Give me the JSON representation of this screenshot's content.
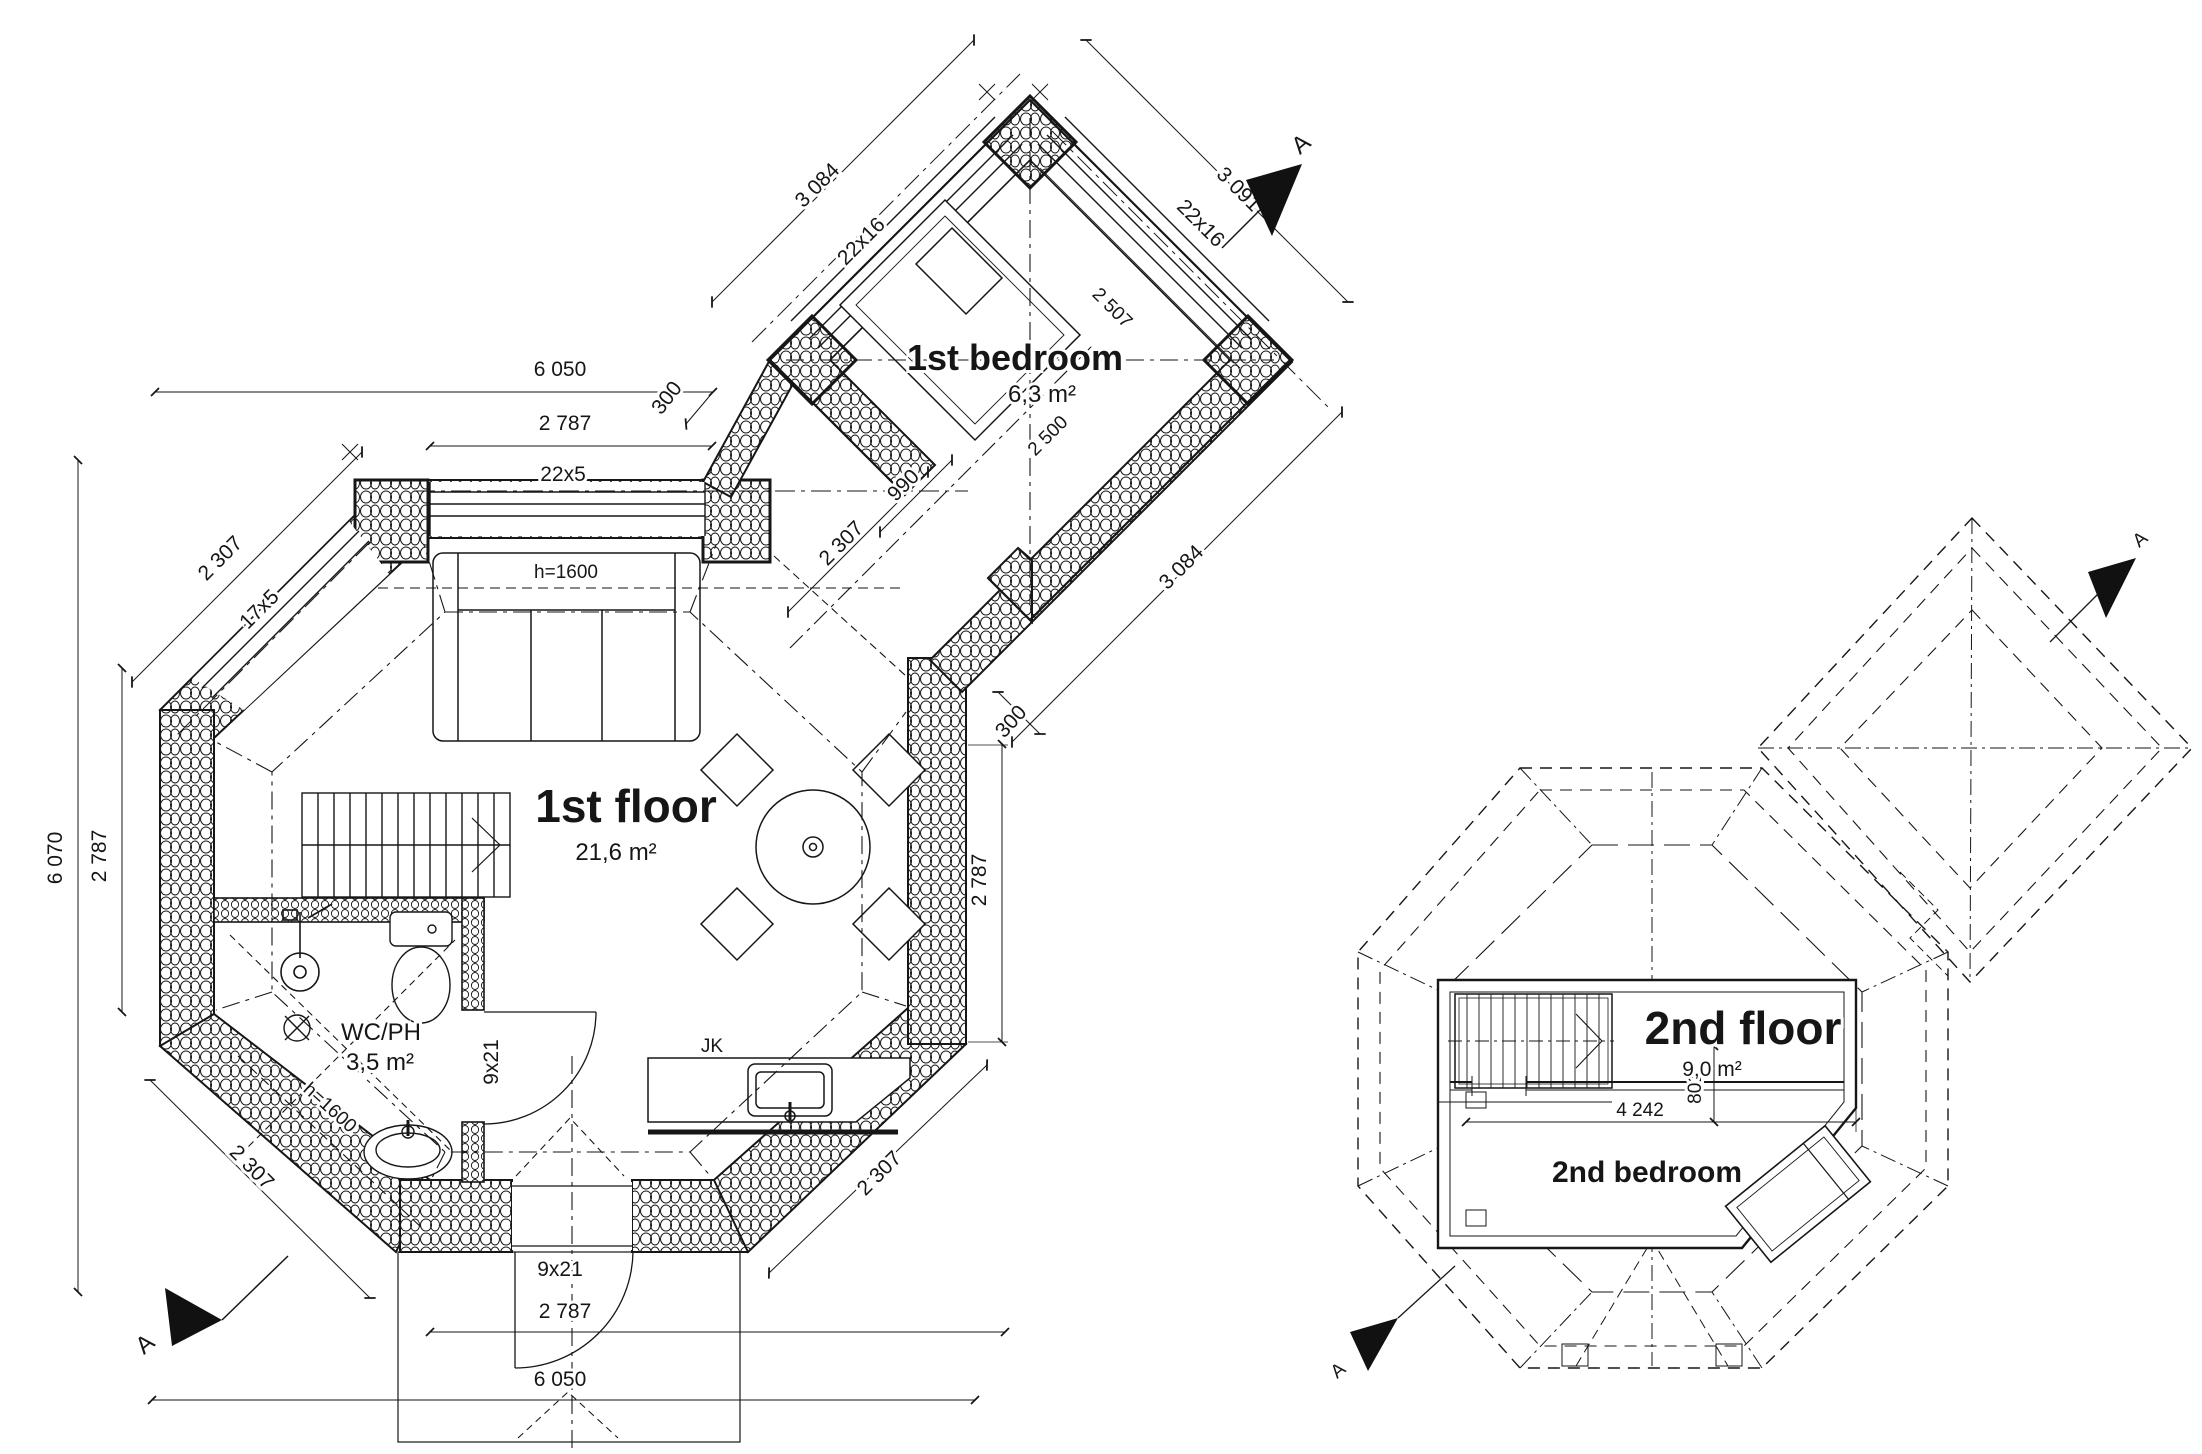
{
  "drawing": {
    "background": "#ffffff",
    "line_color": "#161616"
  },
  "first_floor": {
    "title": "1st floor",
    "area": "21,6 m²",
    "wc_label": "WC/PH",
    "wc_area": "3,5 m²",
    "kitchen_label": "JK",
    "sofa_height_label": "h=1600",
    "wc_height_label": "h=1600",
    "bedroom_title": "1st bedroom",
    "bedroom_area": "6,3 m²",
    "section_label": "A",
    "dims": {
      "top_total": "6 050",
      "top_offset": "300",
      "top_inner": "2 787",
      "top_window": "22x5",
      "upper_left_diag": "2 307",
      "upper_left_window": "17x5",
      "left_total": "6 070",
      "left_inner": "2 787",
      "right_inner": "2 787",
      "corridor_offset": "300",
      "corridor_width": "990",
      "corridor_diag": "2 307",
      "lower_left_diag": "2 307",
      "lower_right_diag": "2 307",
      "entry_door": "9x21",
      "wc_door": "9x21",
      "bottom_inner": "2 787",
      "bottom_total": "6 050",
      "bedroom_nw_len": "3 084",
      "bedroom_nw_window": "22x16",
      "bedroom_ne_len": "3 091",
      "bedroom_ne_window": "22x16",
      "bedroom_se_len": "3 084",
      "bedroom_inner_ne": "2 507",
      "bedroom_inner_se": "2 500"
    }
  },
  "second_floor": {
    "title": "2nd floor",
    "area": "9,0 m²",
    "bedroom_title": "2nd bedroom",
    "section_label": "A",
    "dims": {
      "room_width": "4 242",
      "room_offset": "801"
    }
  }
}
